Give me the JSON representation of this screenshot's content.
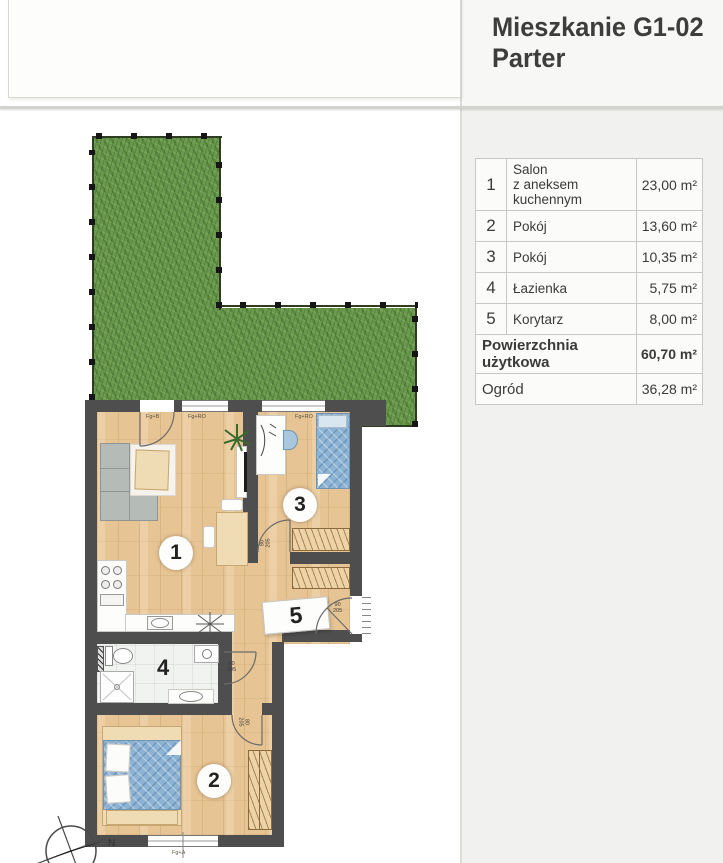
{
  "header": {
    "title_line1": "Mieszkanie G1-02",
    "title_line2": "Parter"
  },
  "legend": {
    "rows": [
      {
        "no": "1",
        "name": "Salon",
        "name2": "z aneksem kuchennym",
        "area": "23,00 m²"
      },
      {
        "no": "2",
        "name": "Pokój",
        "name2": "",
        "area": "13,60 m²"
      },
      {
        "no": "3",
        "name": "Pokój",
        "name2": "",
        "area": "10,35 m²"
      },
      {
        "no": "4",
        "name": "Łazienka",
        "name2": "",
        "area": "5,75 m²"
      },
      {
        "no": "5",
        "name": "Korytarz",
        "name2": "",
        "area": "8,00 m²"
      }
    ],
    "total_label": "Powierzchnia użytkowa",
    "total_area": "60,70 m²",
    "garden_label": "Ogród",
    "garden_area": "36,28 m²"
  },
  "plan": {
    "rooms": [
      "1",
      "2",
      "3",
      "4",
      "5"
    ],
    "doors": {
      "entrance": {
        "w": "90",
        "h": "205"
      },
      "room3": {
        "w": "80",
        "h": "205"
      },
      "bath": {
        "w": "80",
        "h": "205"
      },
      "room2": {
        "w": "80",
        "h": "205"
      }
    },
    "windows": {
      "balcony": "Fg+B",
      "salon": "Fg+RO",
      "room3": "Fg+RO",
      "room2": "Fg+A"
    },
    "compass_label": "N",
    "colors": {
      "wall": "#4e4e4e",
      "grass": "#6a9a4d",
      "wood": "#e7c493",
      "fabric_blue": "#8cb3d3",
      "furniture_beige": "#f0dcb4"
    }
  }
}
